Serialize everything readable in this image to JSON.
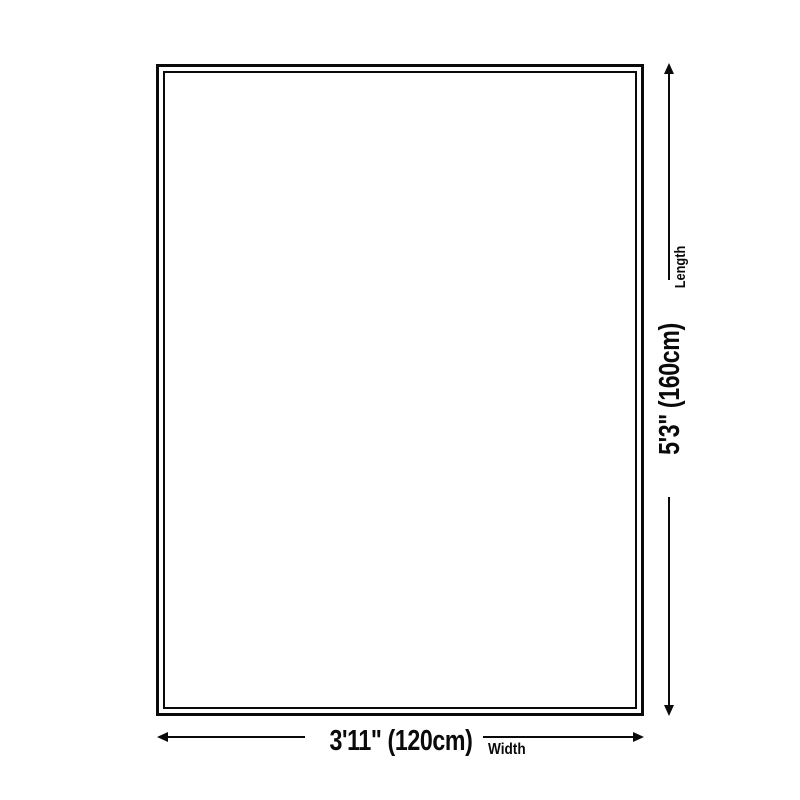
{
  "colors": {
    "background": "#ffffff",
    "line": "#0a0a0a",
    "text": "#0a0a0a"
  },
  "diagram": {
    "type": "product-size-diagram",
    "shape": "rectangle-double-border",
    "dimensions": {
      "length": {
        "value": "5'3\" (160cm)",
        "label": "Length"
      },
      "width": {
        "value": "3'11\" (120cm)",
        "label": "Width"
      }
    },
    "icons": {
      "arrow_up": "triangle-up",
      "arrow_down": "triangle-down",
      "arrow_left": "triangle-left",
      "arrow_right": "triangle-right"
    }
  }
}
